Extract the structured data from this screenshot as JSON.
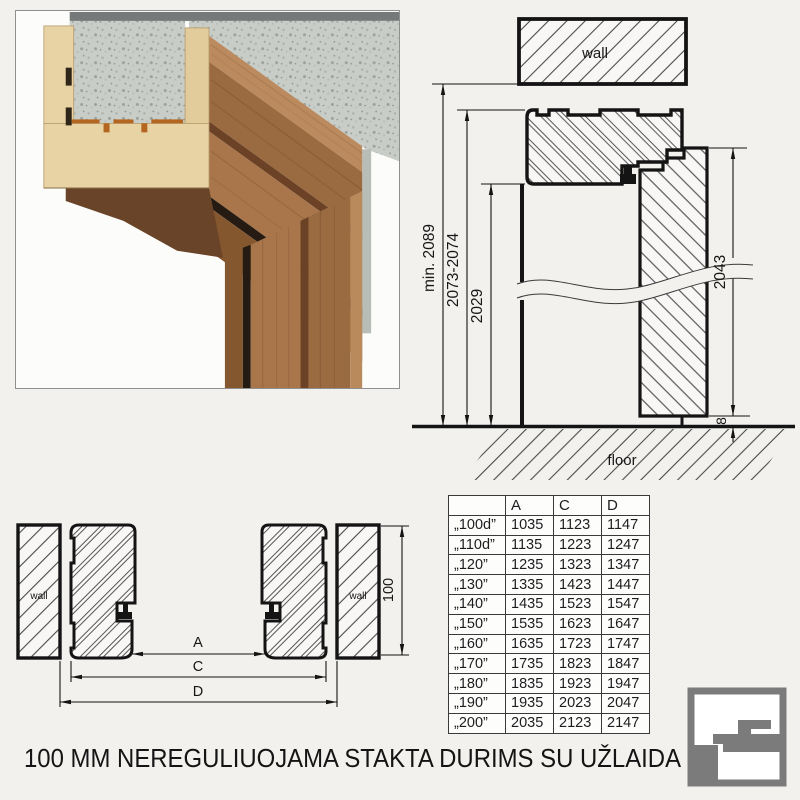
{
  "colors": {
    "background": "#f2f1ee",
    "line": "#141414",
    "hatch": "#4a4a4a",
    "wood_face": "#9a6a40",
    "wood_top": "#bb8a5e",
    "mdf_cream": "#e7d3a3",
    "concrete": "#c9cdc8",
    "seal_black": "#251b12",
    "logo_grey": "#7b7b7b"
  },
  "vertical_section": {
    "wall_label": "wall",
    "floor_label": "floor",
    "dim_total_height": "min. 2089",
    "dim_frame_height": "2073-2074",
    "dim_opening_height": "2029",
    "dim_leaf_height": "2043",
    "dim_floor_gap": "8"
  },
  "horizontal_section": {
    "wall_left_label": "wall",
    "wall_right_label": "wall",
    "dim_a": "A",
    "dim_c": "C",
    "dim_d": "D",
    "dim_depth": "100"
  },
  "table": {
    "headers": [
      "",
      "A",
      "C",
      "D"
    ],
    "rows": [
      {
        "size": "„100d”",
        "a": "1035",
        "c": "1123",
        "d": "1147"
      },
      {
        "size": "„110d”",
        "a": "1135",
        "c": "1223",
        "d": "1247"
      },
      {
        "size": "„120”",
        "a": "1235",
        "c": "1323",
        "d": "1347"
      },
      {
        "size": "„130”",
        "a": "1335",
        "c": "1423",
        "d": "1447"
      },
      {
        "size": "„140”",
        "a": "1435",
        "c": "1523",
        "d": "1547"
      },
      {
        "size": "„150”",
        "a": "1535",
        "c": "1623",
        "d": "1647"
      },
      {
        "size": "„160”",
        "a": "1635",
        "c": "1723",
        "d": "1747"
      },
      {
        "size": "„170”",
        "a": "1735",
        "c": "1823",
        "d": "1847"
      },
      {
        "size": "„180”",
        "a": "1835",
        "c": "1923",
        "d": "1947"
      },
      {
        "size": "„190”",
        "a": "1935",
        "c": "2023",
        "d": "2047"
      },
      {
        "size": "„200”",
        "a": "2035",
        "c": "2123",
        "d": "2147"
      }
    ]
  },
  "caption": "100 MM NEREGULIUOJAMA STAKTA DURIMS SU UŽLAIDA"
}
